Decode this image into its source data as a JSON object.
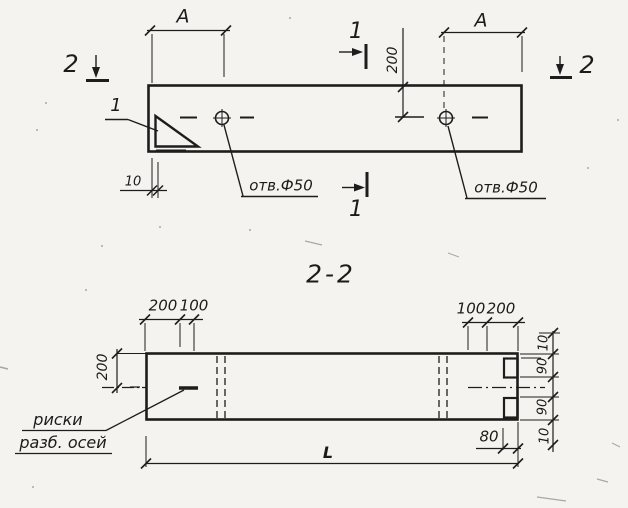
{
  "top_view": {
    "span_label_left": "A",
    "span_label_right": "A",
    "section_mark_1": "1",
    "section_mark_2": "2",
    "edge_offset_dim": "10",
    "hole_offset_dim": "200",
    "hole_label_left": "отв.Ф50",
    "hole_label_right": "отв.Ф50",
    "corner_detail_callout": "1"
  },
  "section_view": {
    "title": "2-2",
    "top_dims_left": [
      "200",
      "100"
    ],
    "top_dims_right": [
      "100",
      "200"
    ],
    "half_height_dim": "200",
    "right_edge_dims": [
      "10",
      "90",
      "90",
      "10"
    ],
    "groove_depth_dim": "80",
    "length_dim": "L",
    "axes_note": [
      "риски",
      "разб. осей"
    ]
  },
  "colors": {
    "paper": "#f4f3ef",
    "ink": "#1d1d1d"
  }
}
